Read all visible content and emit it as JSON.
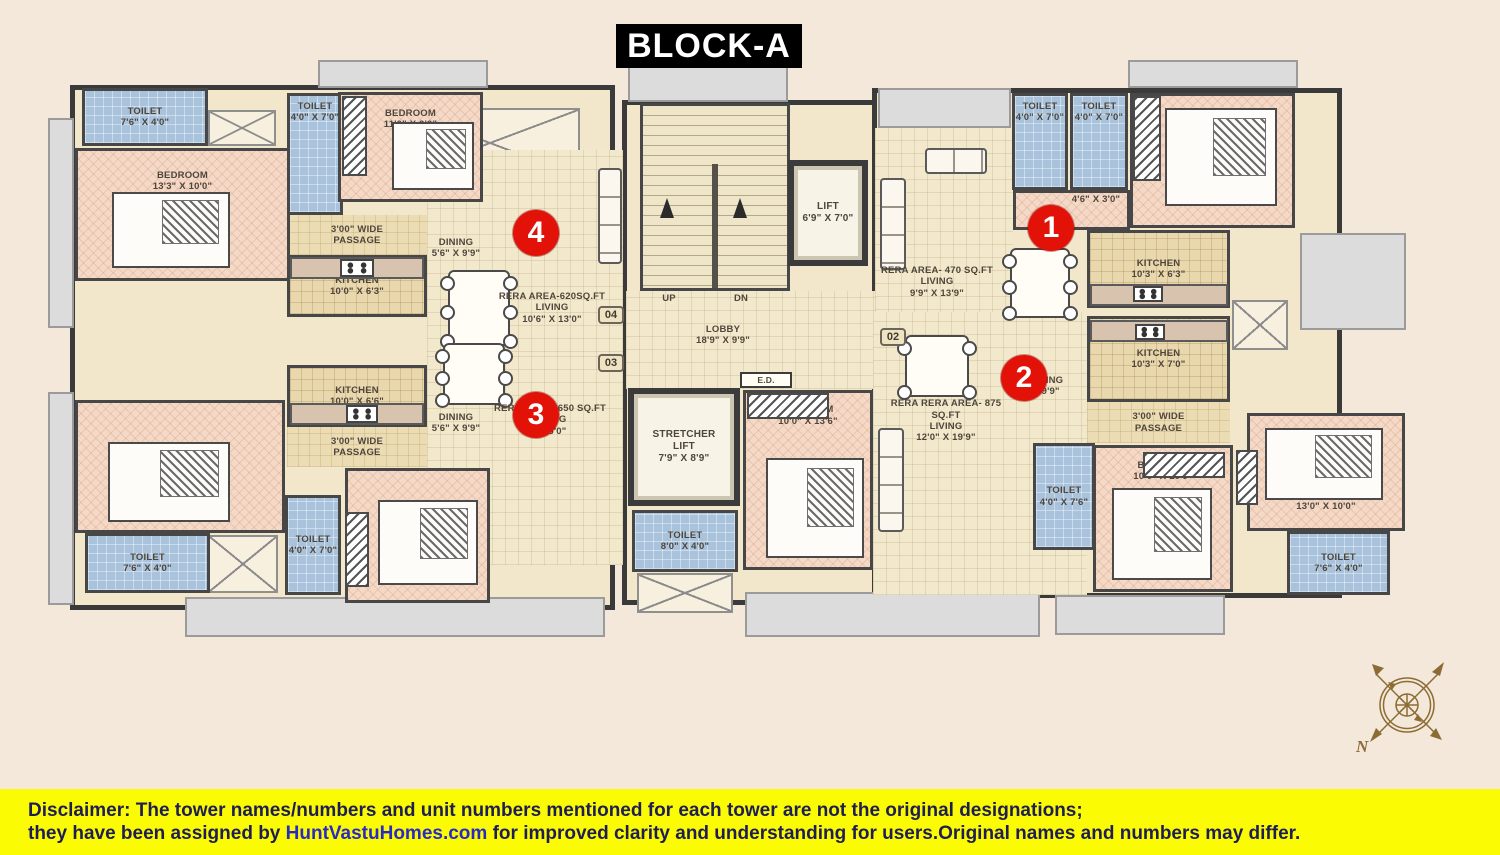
{
  "title": "BLOCK-A",
  "compass": {
    "north_label": "N"
  },
  "disclaimer": {
    "label": "Disclaimer:",
    "line1_rest": " The tower names/numbers and unit numbers mentioned for each tower are not the original designations;",
    "line2_pre": "they have been assigned by ",
    "site": "HuntVastuHomes.com",
    "line2_post": " for improved clarity and understanding for users.Original names and numbers may differ."
  },
  "colors": {
    "background": "#f3e8da",
    "walls": "#474747",
    "bedroom_fill": "#f4d9c6",
    "toilet_fill": "#a9c3dd",
    "kitchen_fill": "#e9d7ad",
    "living_fill": "#f2e8cc",
    "marker_red": "#e31208",
    "disclaimer_yellow": "#fbfb04",
    "title_bg": "#000000",
    "compass_gold": "#8c6c34"
  },
  "markers": [
    {
      "number": "4",
      "x": 513,
      "y": 210
    },
    {
      "number": "3",
      "x": 513,
      "y": 392
    },
    {
      "number": "1",
      "x": 1028,
      "y": 205
    },
    {
      "number": "2",
      "x": 1001,
      "y": 355
    }
  ],
  "rooms": [
    {
      "name": "shell-left-wing",
      "type": "shell",
      "rect": [
        70,
        85,
        545,
        525
      ]
    },
    {
      "name": "shell-center-core",
      "type": "shell",
      "rect": [
        622,
        100,
        262,
        505
      ]
    },
    {
      "name": "shell-right-wing",
      "type": "shell",
      "rect": [
        872,
        88,
        470,
        510
      ]
    },
    {
      "name": "balcony-left-upper",
      "type": "balcony",
      "rect": [
        48,
        118,
        26,
        210
      ]
    },
    {
      "name": "balcony-left-lower",
      "type": "balcony",
      "rect": [
        48,
        392,
        26,
        213
      ]
    },
    {
      "name": "balcony-top-left",
      "type": "balcony",
      "rect": [
        318,
        60,
        170,
        28
      ]
    },
    {
      "name": "balcony-top-stairs",
      "type": "balcony",
      "rect": [
        628,
        60,
        160,
        42
      ]
    },
    {
      "name": "balcony-unit1-top",
      "type": "balcony",
      "rect": [
        878,
        88,
        133,
        40
      ]
    },
    {
      "name": "balcony-top-right",
      "type": "balcony",
      "rect": [
        1128,
        60,
        170,
        28
      ]
    },
    {
      "name": "balcony-right",
      "type": "balcony",
      "rect": [
        1300,
        233,
        106,
        97
      ]
    },
    {
      "name": "balcony-bottom-left",
      "type": "balcony",
      "rect": [
        185,
        597,
        420,
        40
      ]
    },
    {
      "name": "balcony-bottom-center",
      "type": "balcony",
      "rect": [
        745,
        592,
        295,
        45
      ]
    },
    {
      "name": "balcony-bottom-right",
      "type": "balcony",
      "rect": [
        1055,
        595,
        170,
        40
      ]
    },
    {
      "name": "void-box-top-left",
      "type": "crossbox",
      "rect": [
        208,
        110,
        68,
        36
      ]
    },
    {
      "name": "void-box-top-center",
      "type": "crossbox",
      "rect": [
        400,
        108,
        180,
        70
      ]
    },
    {
      "name": "void-box-bottom-left",
      "type": "crossbox",
      "rect": [
        208,
        535,
        70,
        58
      ]
    },
    {
      "name": "void-box-bottom-mid",
      "type": "crossbox",
      "rect": [
        637,
        573,
        96,
        40
      ]
    },
    {
      "name": "void-box-right",
      "type": "crossbox",
      "rect": [
        1232,
        300,
        56,
        50
      ]
    },
    {
      "name": "unit4-toilet-1",
      "type": "toilet",
      "rect": [
        82,
        88,
        126,
        58
      ],
      "label": [
        "TOILET",
        "7'6\" X 4'0\""
      ],
      "labelPos": "center"
    },
    {
      "name": "unit4-bedroom-1",
      "type": "bedroom",
      "rect": [
        75,
        148,
        215,
        133
      ],
      "label": [
        "BEDROOM",
        "13'3\" X 10'0\""
      ],
      "labelPos": "top"
    },
    {
      "name": "unit4-toilet-2",
      "type": "toilet",
      "rect": [
        287,
        93,
        56,
        122
      ],
      "label": [
        "TOILET",
        "4'0\" X 7'0\""
      ],
      "labelPos": "top"
    },
    {
      "name": "unit4-bedroom-2",
      "type": "bedroom",
      "rect": [
        338,
        92,
        145,
        110
      ],
      "label": [
        "BEDROOM",
        "11'0\" X 9'0\""
      ],
      "labelPos": "top"
    },
    {
      "name": "unit4-passage",
      "type": "passage",
      "rect": [
        287,
        215,
        140,
        40
      ],
      "label": [
        "3'00\" WIDE",
        "PASSAGE"
      ],
      "labelPos": "center"
    },
    {
      "name": "unit4-kitchen",
      "type": "kitchen",
      "rect": [
        287,
        255,
        140,
        62
      ],
      "label": [
        "KITCHEN",
        "10'0\" X 6'3\""
      ],
      "labelPos": "center"
    },
    {
      "name": "unit4-living-area",
      "type": "living",
      "rect": [
        427,
        150,
        196,
        202
      ]
    },
    {
      "name": "unit4-dining-label",
      "type": "label",
      "rect": [
        418,
        230,
        76,
        36
      ],
      "label": [
        "DINING",
        "5'6\" X 9'9\""
      ],
      "labelPos": "center"
    },
    {
      "name": "unit4-living-label",
      "type": "label",
      "rect": [
        492,
        283,
        120,
        50
      ],
      "label": [
        "RERA AREA-620SQ.FT",
        "LIVING",
        "10'6\" X 13'0\""
      ],
      "labelPos": "center"
    },
    {
      "name": "unit3-kitchen",
      "type": "kitchen",
      "rect": [
        287,
        365,
        140,
        62
      ],
      "label": [
        "KITCHEN",
        "10'0\" X 6'6\""
      ],
      "labelPos": "center"
    },
    {
      "name": "unit3-passage",
      "type": "passage",
      "rect": [
        287,
        427,
        140,
        40
      ],
      "label": [
        "3'00\" WIDE",
        "PASSAGE"
      ],
      "labelPos": "center"
    },
    {
      "name": "unit3-living-area",
      "type": "living",
      "rect": [
        427,
        352,
        196,
        213
      ]
    },
    {
      "name": "unit3-dining-label",
      "type": "label",
      "rect": [
        418,
        405,
        76,
        36
      ],
      "label": [
        "DINING",
        "5'6\" X 9'9\""
      ],
      "labelPos": "center"
    },
    {
      "name": "unit3-living-label",
      "type": "label",
      "rect": [
        490,
        396,
        120,
        48
      ],
      "label": [
        "RERA AREA- 650 SQ.FT",
        "LIVING",
        "X 16'0\""
      ],
      "labelPos": "center"
    },
    {
      "name": "unit3-bedroom-1",
      "type": "bedroom",
      "rect": [
        75,
        400,
        210,
        133
      ],
      "label": [
        "BEDROOM",
        "13'3\" X 9'9\""
      ],
      "labelPos": "bottom"
    },
    {
      "name": "unit3-toilet-1",
      "type": "toilet",
      "rect": [
        85,
        533,
        125,
        60
      ],
      "label": [
        "TOILET",
        "7'6\" X 4'0\""
      ],
      "labelPos": "center"
    },
    {
      "name": "unit3-toilet-2",
      "type": "toilet",
      "rect": [
        285,
        495,
        56,
        100
      ],
      "label": [
        "TOILET",
        "4'0\" X 7'0\""
      ],
      "labelPos": "center"
    },
    {
      "name": "unit3-bedroom-2",
      "type": "bedroom",
      "rect": [
        345,
        468,
        145,
        135
      ],
      "label": [
        "BEDROOM",
        "11'0\" X 9'0\""
      ],
      "labelPos": "bottom"
    },
    {
      "name": "staircase",
      "type": "stairs",
      "rect": [
        640,
        103,
        150,
        188
      ]
    },
    {
      "name": "lobby-area",
      "type": "lobby",
      "rect": [
        626,
        291,
        256,
        98
      ]
    },
    {
      "name": "stairs-up-label",
      "type": "label",
      "rect": [
        652,
        292,
        34,
        14
      ],
      "label": [
        "UP"
      ],
      "labelPos": "center"
    },
    {
      "name": "stairs-dn-label",
      "type": "label",
      "rect": [
        724,
        292,
        34,
        14
      ],
      "label": [
        "DN"
      ],
      "labelPos": "center"
    },
    {
      "name": "lobby-label",
      "type": "label",
      "rect": [
        688,
        318,
        70,
        34
      ],
      "label": [
        "LOBBY",
        "18'9\" X 9'9\""
      ],
      "labelPos": "center"
    },
    {
      "name": "lift",
      "type": "liftbox",
      "rect": [
        788,
        160,
        80,
        106
      ],
      "label": [
        "LIFT",
        "6'9\" X 7'0\""
      ],
      "labelPos": "center"
    },
    {
      "name": "electrical-duct",
      "type": "ed",
      "rect": [
        740,
        372,
        52,
        16
      ],
      "label": [
        "E.D."
      ],
      "labelPos": "center"
    },
    {
      "name": "stretcher-lift",
      "type": "liftbox",
      "rect": [
        628,
        388,
        112,
        118
      ],
      "label": [
        "STRETCHER",
        "LIFT",
        "7'9\" X 8'9\""
      ],
      "labelPos": "center"
    },
    {
      "name": "common-toilet",
      "type": "toilet",
      "rect": [
        632,
        510,
        106,
        62
      ],
      "label": [
        "TOILET",
        "8'0\" X 4'0\""
      ],
      "labelPos": "center"
    },
    {
      "name": "unit2-bedroom-1",
      "type": "bedroom",
      "rect": [
        743,
        390,
        130,
        180
      ],
      "label": [
        "BEDROOM",
        "10'0\" X 13'6\""
      ],
      "labelPos": "top"
    },
    {
      "name": "unit1-living-area",
      "type": "living",
      "rect": [
        875,
        128,
        138,
        208
      ]
    },
    {
      "name": "unit1-living-label",
      "type": "label",
      "rect": [
        878,
        258,
        118,
        48
      ],
      "label": [
        "RERA AREA- 470 SQ.FT",
        "LIVING",
        "9'9\" X 13'9\""
      ],
      "labelPos": "center"
    },
    {
      "name": "unit1-toilet-1",
      "type": "toilet",
      "rect": [
        1012,
        93,
        56,
        97
      ],
      "label": [
        "TOILET",
        "4'0\" X 7'0\""
      ],
      "labelPos": "top"
    },
    {
      "name": "unit1-toilet-2",
      "type": "toilet",
      "rect": [
        1070,
        93,
        58,
        97
      ],
      "label": [
        "TOILET",
        "4'0\" X 7'0\""
      ],
      "labelPos": "top"
    },
    {
      "name": "unit1-hall",
      "type": "bedroomplain",
      "rect": [
        1013,
        190,
        117,
        40
      ]
    },
    {
      "name": "unit1-hall-label",
      "type": "label",
      "rect": [
        1058,
        192,
        76,
        16
      ],
      "label": [
        "4'6\" X 3'0\""
      ],
      "labelPos": "center"
    },
    {
      "name": "unit1-bedroom",
      "type": "bedroom",
      "rect": [
        1130,
        93,
        165,
        135
      ],
      "label": [
        "BEDROOM",
        "12'0\" X 10'3\""
      ],
      "labelPos": "bottom"
    },
    {
      "name": "unit1-kitchen",
      "type": "kitchen",
      "rect": [
        1087,
        230,
        143,
        78
      ],
      "label": [
        "KITCHEN",
        "10'3\" X 6'3\""
      ],
      "labelPos": "center"
    },
    {
      "name": "unit2-kitchen",
      "type": "kitchen",
      "rect": [
        1087,
        316,
        143,
        86
      ],
      "label": [
        "KITCHEN",
        "10'3\" X 7'0\""
      ],
      "labelPos": "center"
    },
    {
      "name": "unit2-passage",
      "type": "passage",
      "rect": [
        1087,
        402,
        143,
        41
      ],
      "label": [
        "3'00\" WIDE",
        "PASSAGE"
      ],
      "labelPos": "center"
    },
    {
      "name": "unit2-living-area",
      "type": "living",
      "rect": [
        873,
        312,
        214,
        283
      ]
    },
    {
      "name": "unit2-living-label",
      "type": "label",
      "rect": [
        876,
        396,
        140,
        50
      ],
      "label": [
        "RERA  RERA AREA- 875 SQ.FT",
        "LIVING",
        "12'0\" X 19'9\""
      ],
      "labelPos": "center"
    },
    {
      "name": "unit2-dining-label",
      "type": "label",
      "rect": [
        1008,
        368,
        76,
        36
      ],
      "label": [
        "DINING",
        "X 9'9\""
      ],
      "labelPos": "center"
    },
    {
      "name": "unit2-bedroom-2",
      "type": "bedroom",
      "rect": [
        1093,
        445,
        140,
        147
      ],
      "label": [
        "BEDROOM",
        "10'0\" X 10'9\""
      ],
      "labelPos": "top"
    },
    {
      "name": "unit2-toilet-1",
      "type": "toilet",
      "rect": [
        1033,
        443,
        62,
        107
      ],
      "label": [
        "TOILET",
        "4'0\" X 7'6\""
      ],
      "labelPos": "center"
    },
    {
      "name": "unit2-bedroom-3",
      "type": "bedroom",
      "rect": [
        1247,
        413,
        158,
        118
      ],
      "label": [
        "BEDROOM",
        "13'0\" X 10'0\""
      ],
      "labelPos": "bottom"
    },
    {
      "name": "unit2-toilet-2",
      "type": "toilet",
      "rect": [
        1287,
        531,
        103,
        64
      ],
      "label": [
        "TOILET",
        "7'6\" X 4'0\""
      ],
      "labelPos": "center"
    }
  ],
  "unit_tags": [
    {
      "text": "04",
      "rect": [
        598,
        306,
        26,
        18
      ]
    },
    {
      "text": "03",
      "rect": [
        598,
        354,
        26,
        18
      ]
    },
    {
      "text": "02",
      "rect": [
        880,
        328,
        26,
        18
      ]
    }
  ],
  "furniture": [
    {
      "type": "bed",
      "rect": [
        112,
        192,
        118,
        76
      ]
    },
    {
      "type": "bed",
      "rect": [
        392,
        122,
        82,
        68
      ]
    },
    {
      "type": "bed",
      "rect": [
        108,
        442,
        122,
        80
      ]
    },
    {
      "type": "bed",
      "rect": [
        378,
        500,
        100,
        85
      ]
    },
    {
      "type": "bed",
      "rect": [
        766,
        458,
        98,
        100
      ]
    },
    {
      "type": "bed",
      "rect": [
        1112,
        488,
        100,
        92
      ]
    },
    {
      "type": "bed",
      "rect": [
        1165,
        108,
        112,
        98
      ]
    },
    {
      "type": "bed",
      "rect": [
        1265,
        428,
        118,
        72
      ]
    },
    {
      "type": "wardrobe",
      "rect": [
        342,
        96,
        25,
        80
      ]
    },
    {
      "type": "wardrobe",
      "rect": [
        345,
        512,
        24,
        75
      ]
    },
    {
      "type": "wardrobe",
      "rect": [
        747,
        393,
        82,
        26
      ]
    },
    {
      "type": "wardrobe",
      "rect": [
        1133,
        96,
        28,
        85
      ]
    },
    {
      "type": "wardrobe",
      "rect": [
        1143,
        452,
        82,
        26
      ]
    },
    {
      "type": "wardrobe",
      "rect": [
        1236,
        450,
        22,
        55
      ]
    },
    {
      "type": "table",
      "seats": 6,
      "rect": [
        448,
        270,
        62,
        76
      ]
    },
    {
      "type": "table",
      "seats": 6,
      "rect": [
        443,
        343,
        62,
        62
      ]
    },
    {
      "type": "table",
      "seats": 6,
      "rect": [
        1010,
        248,
        60,
        70
      ]
    },
    {
      "type": "table",
      "seats": 4,
      "rect": [
        905,
        335,
        64,
        62
      ]
    },
    {
      "type": "sofa v",
      "rect": [
        598,
        168,
        24,
        96
      ]
    },
    {
      "type": "sofa v",
      "rect": [
        880,
        178,
        26,
        92
      ]
    },
    {
      "type": "sofa h",
      "rect": [
        925,
        148,
        62,
        26
      ]
    },
    {
      "type": "sofa v",
      "rect": [
        878,
        428,
        26,
        104
      ]
    },
    {
      "type": "counter",
      "rect": [
        290,
        257,
        134,
        22
      ]
    },
    {
      "type": "counter",
      "rect": [
        290,
        403,
        134,
        22
      ]
    },
    {
      "type": "counter",
      "rect": [
        1090,
        284,
        138,
        22
      ]
    },
    {
      "type": "counter",
      "rect": [
        1090,
        320,
        138,
        22
      ]
    },
    {
      "type": "stove",
      "rect": [
        340,
        259,
        34,
        18
      ]
    },
    {
      "type": "stove",
      "rect": [
        346,
        405,
        32,
        18
      ]
    },
    {
      "type": "stove",
      "rect": [
        1133,
        286,
        30,
        16
      ]
    },
    {
      "type": "stove",
      "rect": [
        1135,
        324,
        30,
        16
      ]
    },
    {
      "type": "uparrow",
      "rect": [
        660,
        198,
        14,
        20
      ]
    },
    {
      "type": "uparrow",
      "rect": [
        733,
        198,
        14,
        20
      ]
    }
  ]
}
